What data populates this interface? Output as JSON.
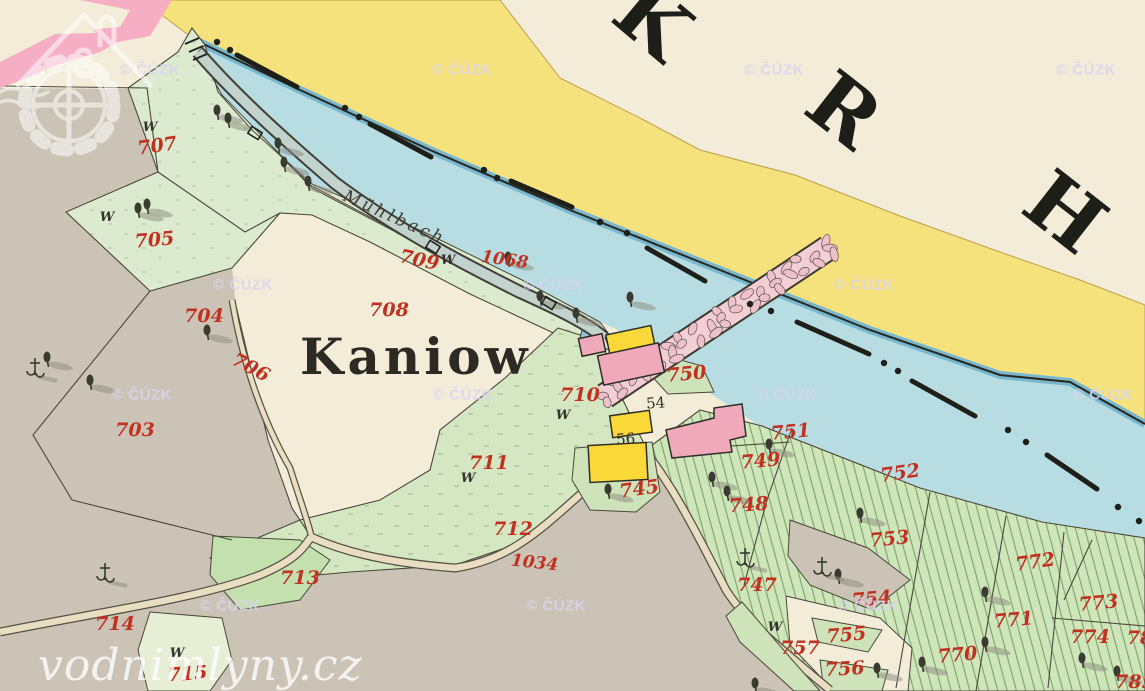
{
  "map": {
    "region_name_letters": [
      {
        "ch": "K",
        "x": 635,
        "y": 42,
        "rot": 40
      },
      {
        "ch": "R",
        "x": 827,
        "y": 132,
        "rot": 38
      },
      {
        "ch": "H",
        "x": 1048,
        "y": 234,
        "rot": 38
      }
    ],
    "place_labels": {
      "village": "Kaniow",
      "stream": "Mühlbach"
    },
    "house_numbers": [
      {
        "t": "54",
        "x": 656,
        "y": 408,
        "r": -4
      },
      {
        "t": "56",
        "x": 626,
        "y": 444,
        "r": -4
      }
    ],
    "parcel_labels": [
      {
        "t": "707",
        "x": 158,
        "y": 152,
        "r": -8
      },
      {
        "t": "705",
        "x": 155,
        "y": 246,
        "r": -5
      },
      {
        "t": "709",
        "x": 418,
        "y": 266,
        "r": 12
      },
      {
        "t": "1068",
        "x": 504,
        "y": 265,
        "r": 8
      },
      {
        "t": "708",
        "x": 389,
        "y": 316,
        "r": 0
      },
      {
        "t": "710",
        "x": 580,
        "y": 401,
        "r": 0
      },
      {
        "t": "711",
        "x": 489,
        "y": 469,
        "r": 0
      },
      {
        "t": "712",
        "x": 513,
        "y": 535,
        "r": 0
      },
      {
        "t": "1034",
        "x": 534,
        "y": 568,
        "r": 6
      },
      {
        "t": "713",
        "x": 300,
        "y": 584,
        "r": 0
      },
      {
        "t": "714",
        "x": 115,
        "y": 630,
        "r": 0
      },
      {
        "t": "715",
        "x": 188,
        "y": 680,
        "r": -4
      },
      {
        "t": "703",
        "x": 135,
        "y": 436,
        "r": 0
      },
      {
        "t": "704",
        "x": 204,
        "y": 322,
        "r": 0
      },
      {
        "t": "706",
        "x": 248,
        "y": 373,
        "r": 28
      },
      {
        "t": "750",
        "x": 687,
        "y": 380,
        "r": -5
      },
      {
        "t": "745",
        "x": 640,
        "y": 495,
        "r": -8
      },
      {
        "t": "747",
        "x": 757,
        "y": 591,
        "r": 0
      },
      {
        "t": "748",
        "x": 749,
        "y": 511,
        "r": -4
      },
      {
        "t": "749",
        "x": 761,
        "y": 467,
        "r": -5
      },
      {
        "t": "751",
        "x": 791,
        "y": 438,
        "r": -5
      },
      {
        "t": "752",
        "x": 901,
        "y": 479,
        "r": -8
      },
      {
        "t": "753",
        "x": 890,
        "y": 545,
        "r": -5
      },
      {
        "t": "754",
        "x": 872,
        "y": 605,
        "r": -5
      },
      {
        "t": "755",
        "x": 847,
        "y": 641,
        "r": -5
      },
      {
        "t": "756",
        "x": 845,
        "y": 675,
        "r": -3
      },
      {
        "t": "757",
        "x": 800,
        "y": 654,
        "r": 0
      },
      {
        "t": "770",
        "x": 958,
        "y": 661,
        "r": -5
      },
      {
        "t": "771",
        "x": 1014,
        "y": 626,
        "r": -5
      },
      {
        "t": "772",
        "x": 1036,
        "y": 568,
        "r": -8
      },
      {
        "t": "773",
        "x": 1099,
        "y": 609,
        "r": -5
      },
      {
        "t": "774",
        "x": 1090,
        "y": 643,
        "r": 0
      },
      {
        "t": "78",
        "x": 1140,
        "y": 644,
        "r": 0
      },
      {
        "t": "785",
        "x": 1135,
        "y": 688,
        "r": 0
      }
    ],
    "w_marks": {
      "t": "W",
      "positions": [
        [
          150,
          131
        ],
        [
          107,
          221
        ],
        [
          448,
          264
        ],
        [
          563,
          419
        ],
        [
          468,
          482
        ],
        [
          775,
          631
        ],
        [
          177,
          657
        ]
      ]
    },
    "watermark": {
      "text": "© ČÚZK",
      "positions": [
        [
          150,
          70
        ],
        [
          462,
          70
        ],
        [
          774,
          70
        ],
        [
          1086,
          70
        ],
        [
          243,
          285
        ],
        [
          553,
          285
        ],
        [
          864,
          285
        ],
        [
          142,
          395
        ],
        [
          463,
          395
        ],
        [
          787,
          395
        ],
        [
          1103,
          395
        ],
        [
          230,
          606
        ],
        [
          556,
          606
        ],
        [
          868,
          606
        ]
      ]
    },
    "site_watermark": {
      "text": "vodnimlyny.cz"
    },
    "symbols": {
      "trees": [
        [
          217,
          110
        ],
        [
          228,
          118
        ],
        [
          278,
          143
        ],
        [
          284,
          162
        ],
        [
          308,
          181
        ],
        [
          508,
          257
        ],
        [
          540,
          296
        ],
        [
          576,
          313
        ],
        [
          630,
          297
        ],
        [
          138,
          208
        ],
        [
          147,
          204
        ],
        [
          207,
          330
        ],
        [
          47,
          357
        ],
        [
          90,
          380
        ],
        [
          712,
          477
        ],
        [
          727,
          491
        ],
        [
          769,
          444
        ],
        [
          860,
          513
        ],
        [
          838,
          574
        ],
        [
          985,
          592
        ],
        [
          985,
          642
        ],
        [
          922,
          662
        ],
        [
          1082,
          658
        ],
        [
          1117,
          671
        ],
        [
          877,
          668
        ],
        [
          755,
          683
        ],
        [
          608,
          489
        ]
      ],
      "crosses": [
        [
          105,
          572
        ],
        [
          35,
          367
        ],
        [
          745,
          557
        ],
        [
          822,
          566
        ]
      ],
      "culverts": [
        [
          255,
          133
        ],
        [
          433,
          247
        ],
        [
          549,
          303
        ]
      ]
    },
    "channel_marks": {
      "dashes": [
        [
          237,
          55,
          297,
          87
        ],
        [
          370,
          124,
          431,
          157
        ],
        [
          511,
          181,
          572,
          207
        ],
        [
          647,
          248,
          705,
          281
        ],
        [
          797,
          322,
          869,
          354
        ],
        [
          912,
          381,
          975,
          416
        ],
        [
          1047,
          455,
          1097,
          489
        ]
      ],
      "dots": [
        [
          217,
          42
        ],
        [
          230,
          50
        ],
        [
          345,
          108
        ],
        [
          359,
          117
        ],
        [
          484,
          170
        ],
        [
          497,
          178
        ],
        [
          600,
          222
        ],
        [
          627,
          233
        ],
        [
          750,
          304
        ],
        [
          771,
          311
        ],
        [
          884,
          363
        ],
        [
          898,
          371
        ],
        [
          1008,
          430
        ],
        [
          1026,
          442
        ],
        [
          1118,
          507
        ],
        [
          1139,
          521
        ]
      ]
    },
    "colors": {
      "paper": "#f3ecd8",
      "field_grey": "#cbc4b6",
      "river": "#b7dde2",
      "river_edge": "#79b7cf",
      "road_yellow": "#f6e27c",
      "building_yellow": "#f9d838",
      "building_pink": "#f0a9bb",
      "weir_fill": "#f3ced7",
      "pink_band": "#f6aec4",
      "green_strip": "#dcead0",
      "green_pale": "#e6eed6",
      "green_dark": "#c4e0ae",
      "green_small": "#cfe3bb",
      "road_fill": "#e9ddc2",
      "pond_blue": "#8fc6d8",
      "label_red": "#c2301f",
      "label_black": "#2c2a22",
      "watermark_lavender": "#d9d4f0"
    }
  }
}
